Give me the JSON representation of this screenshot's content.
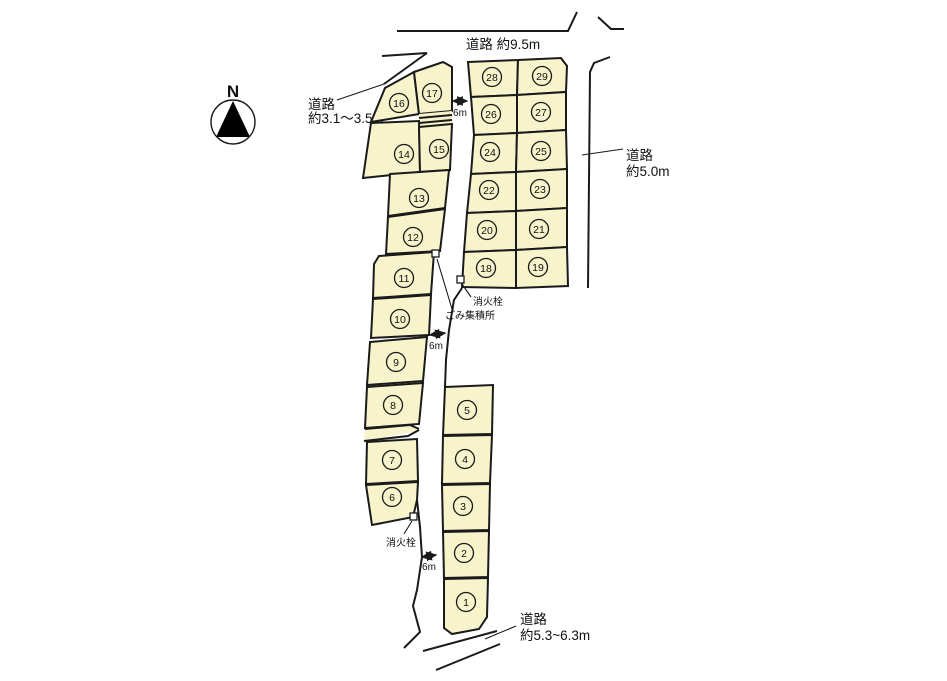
{
  "labels": {
    "north": "N",
    "road_top": "道路 約9.5m",
    "road_left_1": "道路",
    "road_left_2": "約3.1〜3.5m",
    "road_right_1": "道路",
    "road_right_2": "約5.0m",
    "road_bottom_1": "道路",
    "road_bottom_2": "約5.3~6.3m",
    "width_top": "6m",
    "width_mid": "6m",
    "width_bottom": "6m",
    "hydrant_mid": "消火栓",
    "garbage_mid": "ごみ集積所",
    "hydrant_bottom": "消火栓"
  },
  "plot_labels": {
    "1": "1",
    "2": "2",
    "3": "3",
    "4": "4",
    "5": "5",
    "6": "6",
    "7": "7",
    "8": "8",
    "9": "9",
    "10": "10",
    "11": "11",
    "12": "12",
    "13": "13",
    "14": "14",
    "15": "15",
    "16": "16",
    "17": "17",
    "18": "18",
    "19": "19",
    "20": "20",
    "21": "21",
    "22": "22",
    "23": "23",
    "24": "24",
    "25": "25",
    "26": "26",
    "27": "27",
    "28": "28",
    "29": "29"
  },
  "colors": {
    "plot_fill": "#f7f3cb",
    "line_color": "#1a1a1a",
    "background": "#ffffff"
  }
}
